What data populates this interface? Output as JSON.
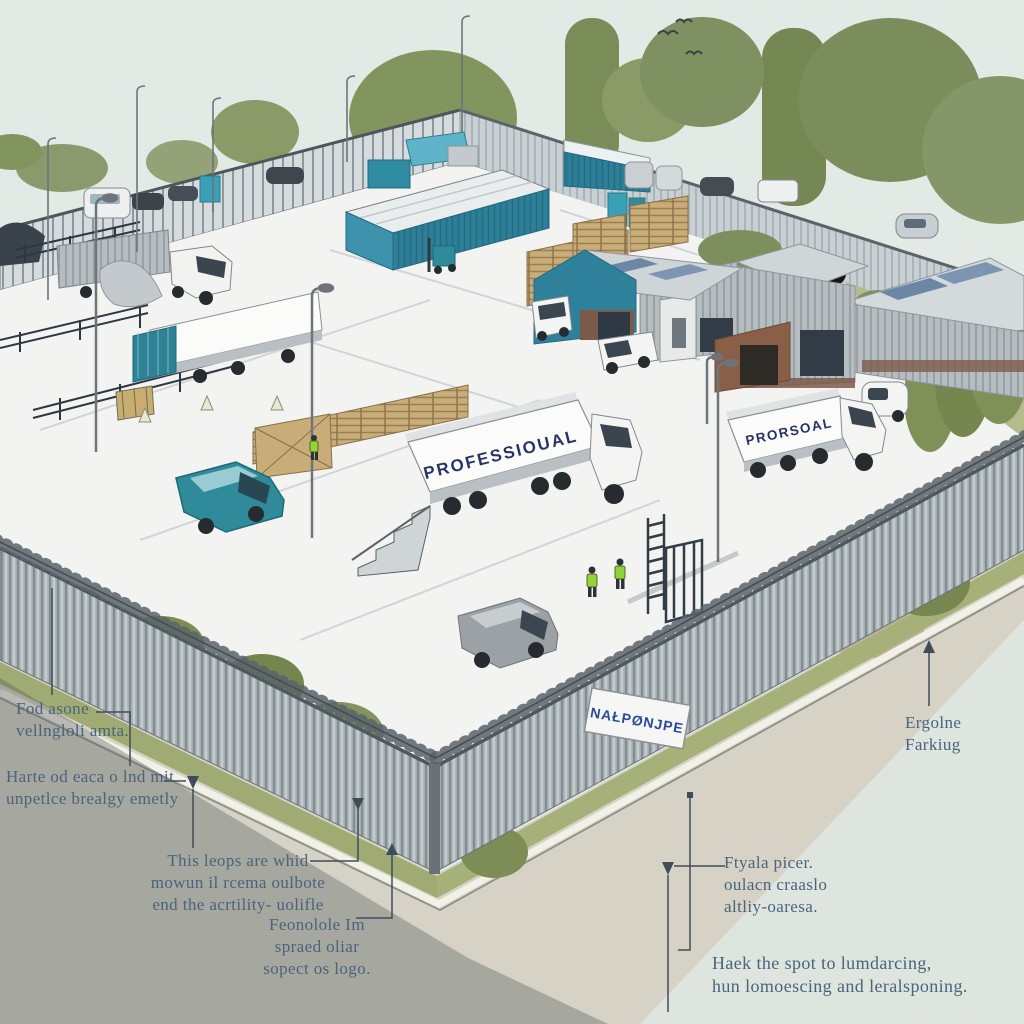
{
  "scene": {
    "truck_center_label": "PROFESSIOUAL",
    "truck_right_label": "PRORSOAL",
    "fence_sign_text": "NAŁPØNJPE"
  },
  "annotations": [
    {
      "id": "vehicle-units",
      "lines": [
        "Fod asone",
        "vellngloli amta."
      ]
    },
    {
      "id": "secure-entry",
      "lines": [
        "Harte od eaca o lnd mit",
        "unpetlce brealgy emetly"
      ]
    },
    {
      "id": "mown-areas",
      "lines": [
        "This leops are whid",
        "mowun il rcema oulbote",
        "end the acrtility- uolifle"
      ]
    },
    {
      "id": "spread-logo",
      "lines": [
        "Feonolole Im",
        "spraed oliar",
        "sopect os logo."
      ]
    },
    {
      "id": "engine-parking",
      "lines": [
        "Ergolne",
        "Farkiug"
      ]
    },
    {
      "id": "utility-access",
      "lines": [
        "Ftyala picer.",
        "oulacn craaslo",
        "altliy-oaresa."
      ]
    },
    {
      "id": "landscaping",
      "lines": [
        "Haek the spot to lumdarcing,",
        "hun lomoescing and leralsponing."
      ]
    }
  ],
  "colors": {
    "sky": "#e3eae6",
    "yard": "#f3f4f1",
    "teal_accent": "#2e8099",
    "tree_green": "#83955f",
    "fence_gray": "#aeb7ba",
    "pavement": "#d6d2c5",
    "shadow": "#5a625e",
    "annotation_text": "#49647d",
    "truck_text": "#2a3366",
    "sign_text": "#2b4a9b",
    "hivis_green": "#96d23c"
  }
}
